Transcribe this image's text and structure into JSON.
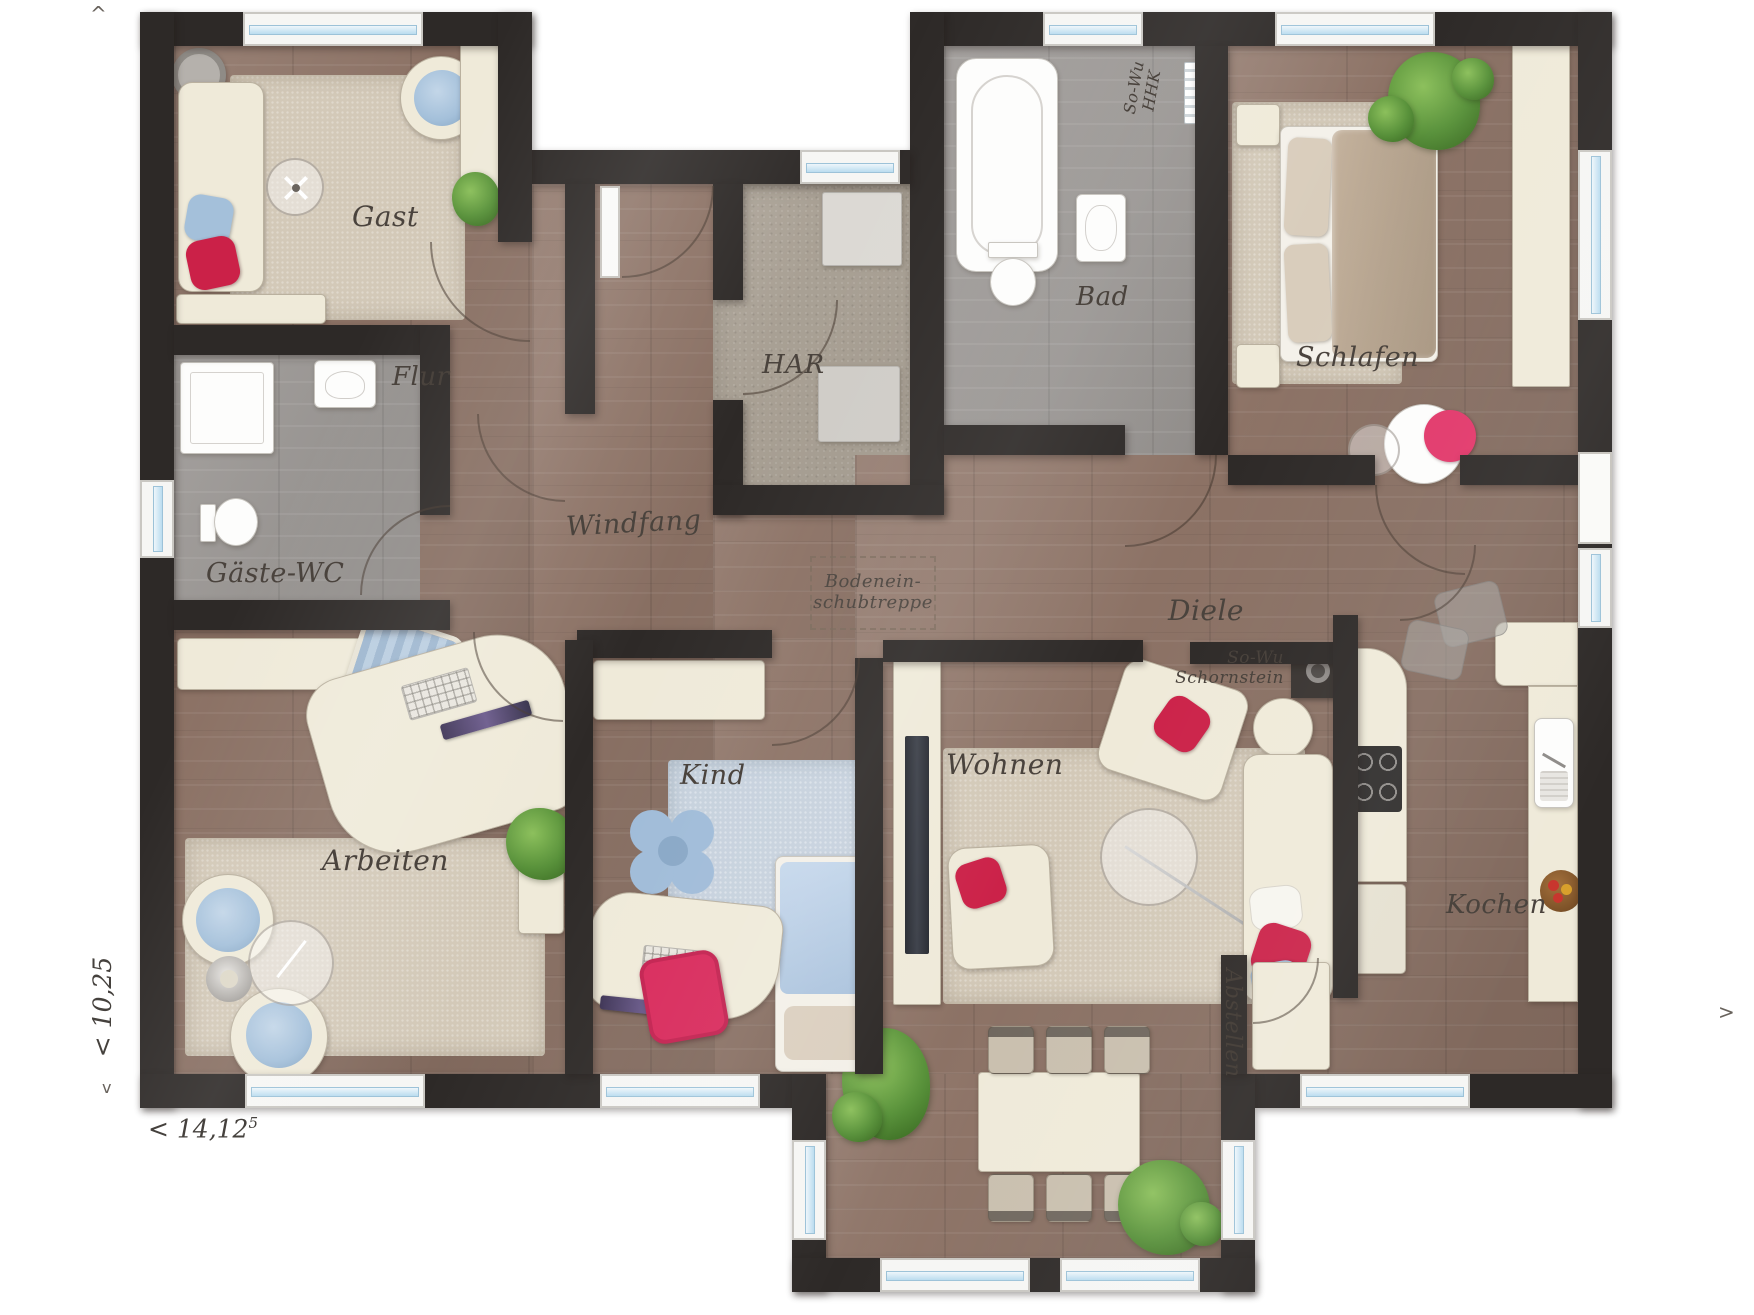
{
  "rooms": {
    "gast": "Gast",
    "flur": "Flur",
    "gaeste_wc": "Gäste-WC",
    "arbeiten": "Arbeiten",
    "windfang": "Windfang",
    "har": "HAR",
    "bad": "Bad",
    "schlafen": "Schlafen",
    "diele": "Diele",
    "kind": "Kind",
    "wohnen": "Wohnen",
    "kochen": "Kochen",
    "abstellen": "Abstellen"
  },
  "annotations": {
    "attic_line1": "Bodenein-",
    "attic_line2": "schubtreppe",
    "towel_line1": "So-Wu",
    "towel_line2": "HHK",
    "chimney_line1": "So-Wu",
    "chimney_line2": "Schornstein"
  },
  "dimensions": {
    "height_label": "< 10,25",
    "width_label": "< 14,12",
    "width_sup": "5",
    "marker_top": "^",
    "marker_bottom": "v",
    "marker_right": ">"
  },
  "colors": {
    "wall": "#2d2927",
    "wood": "#8c7265",
    "wood_gray": "#9a9693",
    "carpet": "#a89f92",
    "rug_beige": "#d3c9b8",
    "rug_blue": "#c6d1dd",
    "furniture_cream": "#efead9",
    "accent_red": "#cb2148",
    "accent_pink": "#e2376a",
    "cushion_blue": "#a4c0da",
    "plant_green": "#58913a",
    "window_glass": "#badcef",
    "label_text": "#4a433d"
  }
}
